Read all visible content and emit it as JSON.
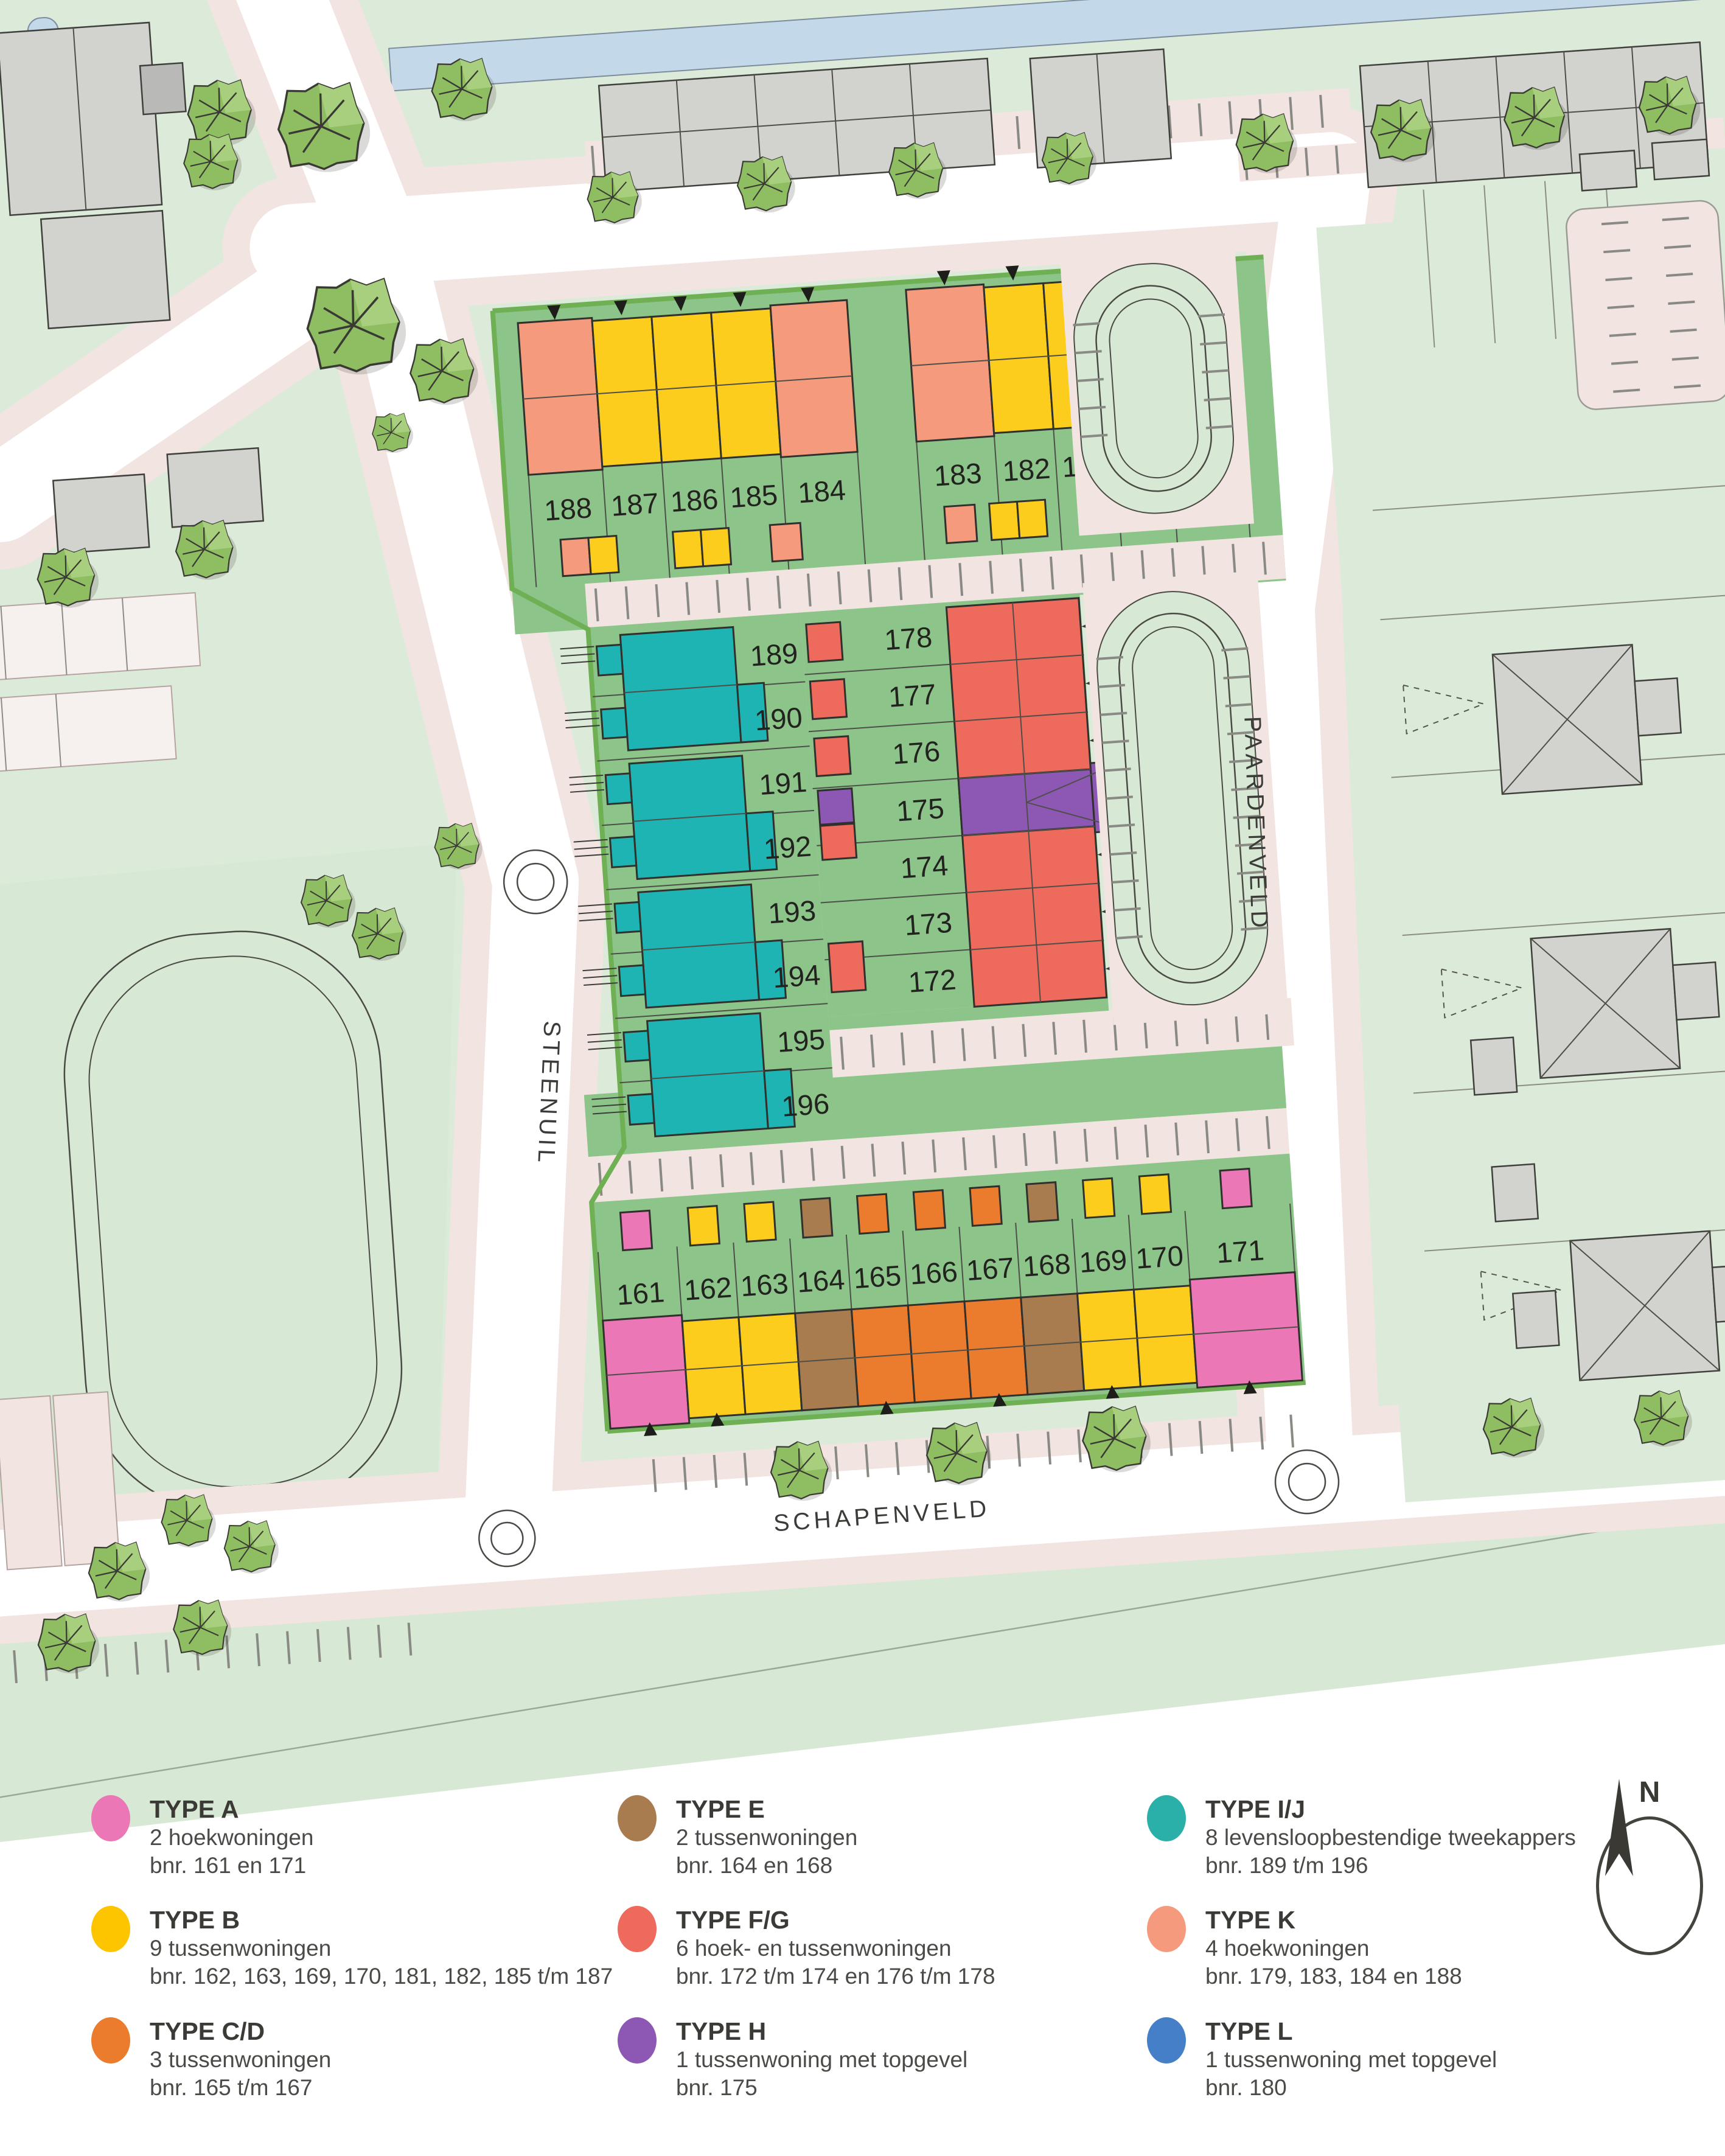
{
  "map": {
    "street_labels": [
      "STEENUIL",
      "PAARDENVELD",
      "SCHAPENVELD"
    ],
    "north_row": [
      "188",
      "187",
      "186",
      "185",
      "184",
      "183",
      "182",
      "181",
      "180",
      "179"
    ],
    "west_column": [
      "189",
      "190",
      "191",
      "192",
      "193",
      "194",
      "195",
      "196"
    ],
    "center_column": [
      "178",
      "177",
      "176",
      "175",
      "174",
      "173",
      "172"
    ],
    "south_row": [
      "161",
      "162",
      "163",
      "164",
      "165",
      "166",
      "167",
      "168",
      "169",
      "170",
      "171"
    ]
  },
  "legend": {
    "entries": [
      {
        "type_label": "TYPE A",
        "color": "#ec77b7",
        "line1": "2 hoekwoningen",
        "line2": "bnr. 161 en 171"
      },
      {
        "type_label": "TYPE B",
        "color": "#fdc500",
        "line1": "9 tussenwoningen",
        "line2": "bnr. 162, 163, 169, 170, 181, 182, 185 t/m 187"
      },
      {
        "type_label": "TYPE C/D",
        "color": "#ec7c2d",
        "line1": "3 tussenwoningen",
        "line2": "bnr. 165 t/m 167"
      },
      {
        "type_label": "TYPE E",
        "color": "#a97c50",
        "line1": "2 tussenwoningen",
        "line2": "bnr. 164 en 168"
      },
      {
        "type_label": "TYPE F/G",
        "color": "#ee6a5c",
        "line1": "6 hoek- en tussenwoningen",
        "line2": "bnr. 172 t/m 174 en 176 t/m 178"
      },
      {
        "type_label": "TYPE H",
        "color": "#8d58b4",
        "line1": "1 tussenwoning met topgevel",
        "line2": "bnr. 175"
      },
      {
        "type_label": "TYPE I/J",
        "color": "#2ab0a9",
        "line1": "8 levensloopbestendige tweekappers",
        "line2": "bnr. 189 t/m 196"
      },
      {
        "type_label": "TYPE K",
        "color": "#f59a7d",
        "line1": "4 hoekwoningen",
        "line2": "bnr. 179, 183, 184 en 188"
      },
      {
        "type_label": "TYPE L",
        "color": "#447fc8",
        "line1": "1 tussenwoning met topgevel",
        "line2": "bnr. 180"
      }
    ],
    "north_label": "N"
  },
  "colors": {
    "A": "#ec77b7",
    "B": "#fccd1d",
    "CD": "#ec7c2d",
    "E": "#a97c50",
    "FG": "#ee6a5c",
    "H": "#8d58b4",
    "IJ": "#1fb4b4",
    "K": "#f59a7d",
    "L": "#447fc8",
    "garden": "#8cc48a",
    "pale": "#dcead9",
    "field": "#d7e8d4",
    "roadpink": "#f2e4e0",
    "water": "#c3d9ea",
    "hedge": "#6fb054",
    "gray": "#d2d2cf"
  }
}
